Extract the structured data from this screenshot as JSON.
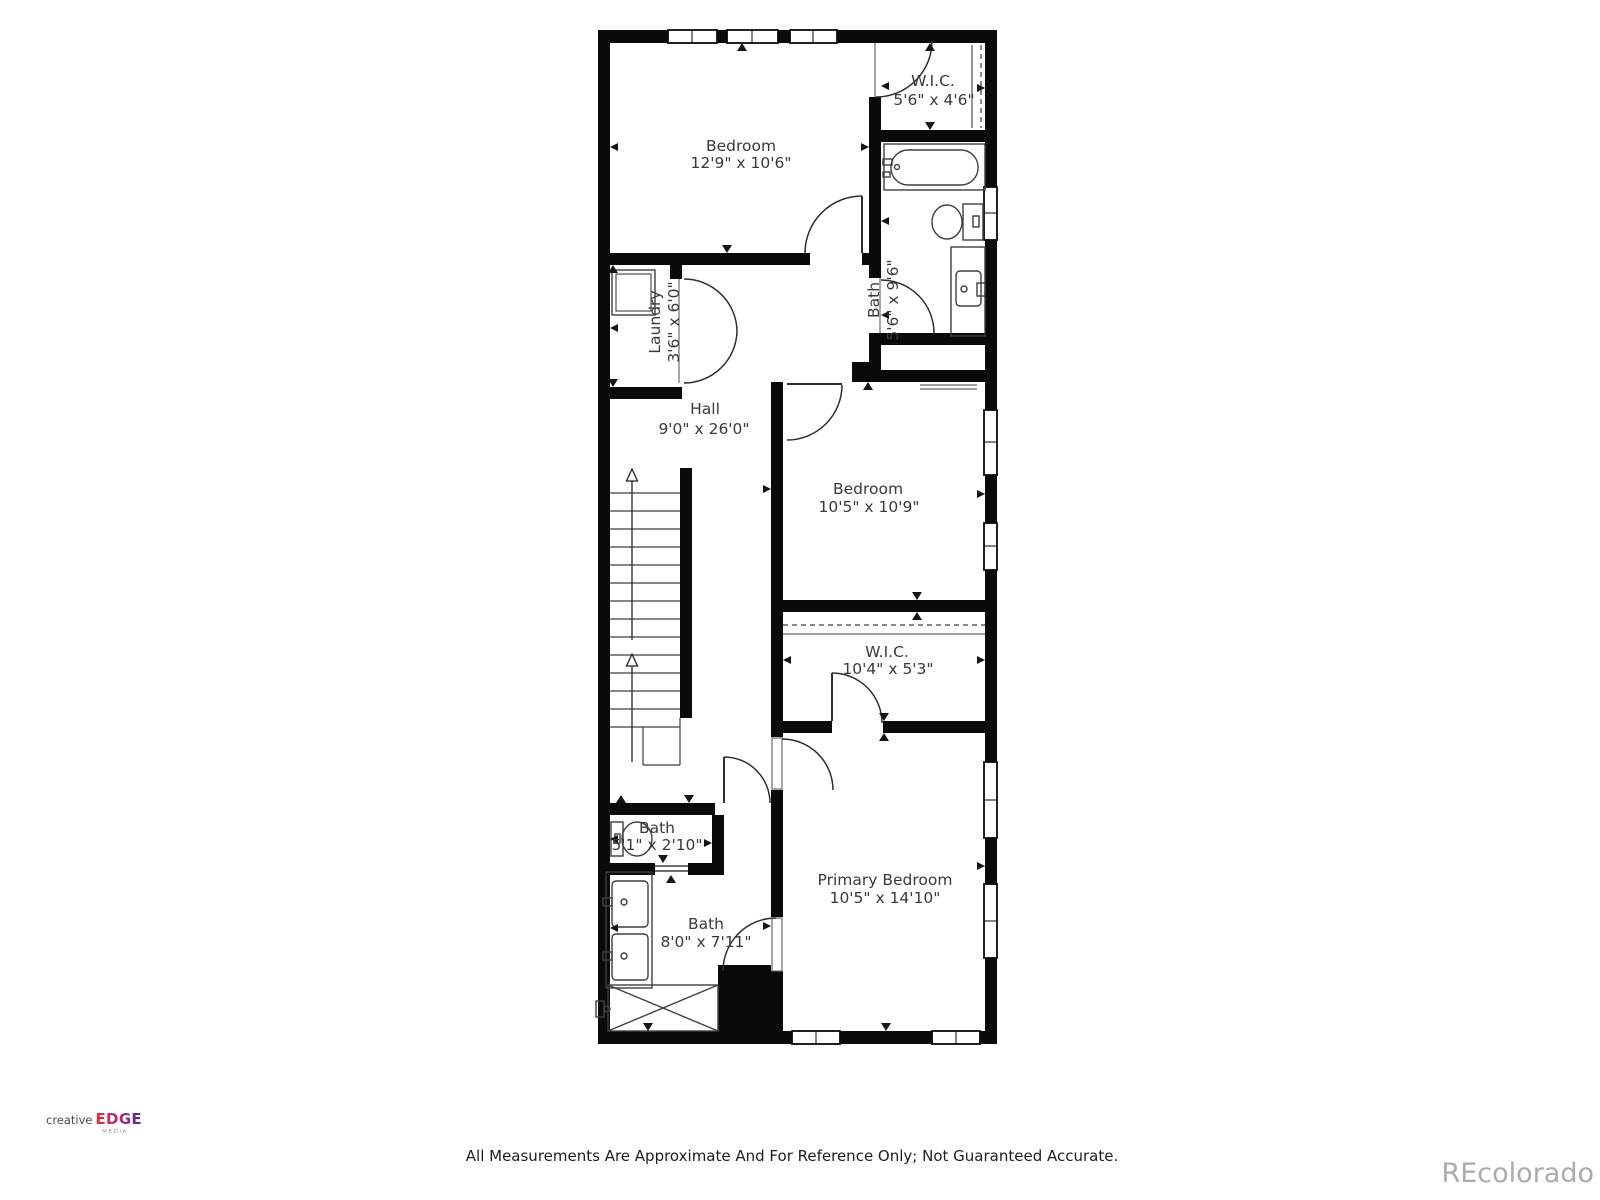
{
  "plan": {
    "rooms": {
      "bedroom1": {
        "name": "Bedroom",
        "dims": "12'9\" x 10'6\""
      },
      "wic1": {
        "name": "W.I.C.",
        "dims": "5'6\" x 4'6\""
      },
      "bath1": {
        "name": "Bath",
        "dims": "5'6\" x 9'6\""
      },
      "laundry": {
        "name": "Laundry",
        "dims": "3'6\" x 6'0\""
      },
      "hall": {
        "name": "Hall",
        "dims": "9'0\" x 26'0\""
      },
      "bedroom2": {
        "name": "Bedroom",
        "dims": "10'5\" x 10'9\""
      },
      "wic2": {
        "name": "W.I.C.",
        "dims": "10'4\" x 5'3\""
      },
      "bath3": {
        "name": "Bath",
        "dims": "5'1\" x 2'10\""
      },
      "bath2": {
        "name": "Bath",
        "dims": "8'0\" x 7'11\""
      },
      "primary": {
        "name": "Primary Bedroom",
        "dims": "10'5\" x 14'10\""
      }
    },
    "wall_color": "#0a0a0a",
    "fixture_line_color": "#3f3f3f",
    "text_color": "#3a3a3a"
  },
  "branding": {
    "creative": "creative",
    "edge": "EDGE",
    "media": "MEDIA",
    "edge_gradient": [
      "#e62e36",
      "#a62a80",
      "#4b2c92"
    ]
  },
  "footer": {
    "disclaimer": "All Measurements Are Approximate And For Reference Only; Not Guaranteed Accurate."
  },
  "watermark": {
    "text": "REcolorado",
    "color": "#ababab"
  }
}
